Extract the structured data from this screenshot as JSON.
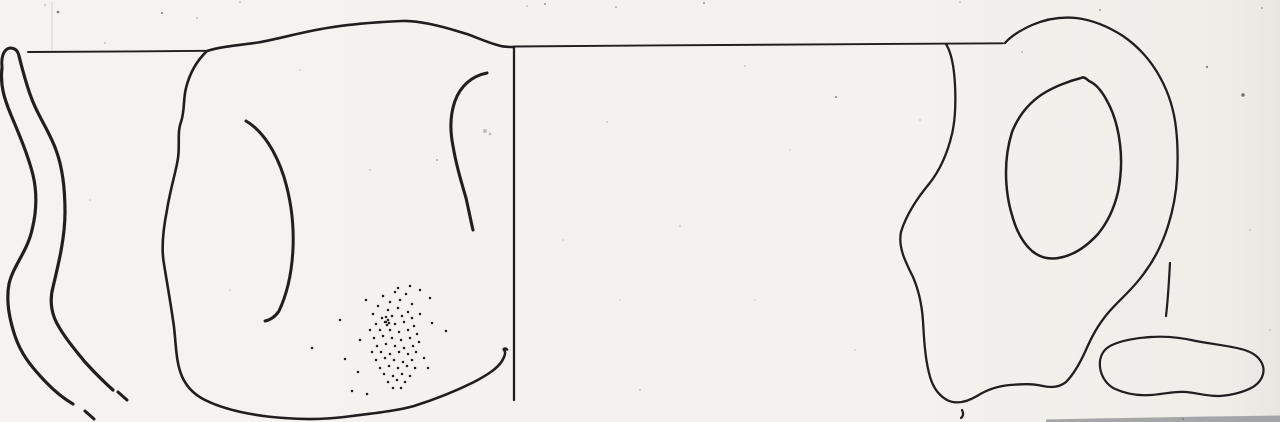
{
  "canvas": {
    "width": 1280,
    "height": 422,
    "paper_color": "#f4f2ee",
    "ink_color": "#1f1f1f",
    "shadow_color": "#97999c"
  },
  "illustration": {
    "strokes": [
      {
        "name": "paper-fold-line",
        "d": "M 52,2 L 52,50",
        "stroke": "#d9d6d0",
        "width": 1.4,
        "opacity": 0.7
      },
      {
        "name": "left-rim-level-line",
        "d": "M 28,52 C 75,51.4 150,51.6 206,50.8",
        "width": 1.9
      },
      {
        "name": "sherd-section-cap",
        "d": "M 2,67 C 1,56 4,49 10,48 C 15,48 18,51 19,56",
        "width": 3
      },
      {
        "name": "sherd-section-outer-edge",
        "d": "M 2,68 C 0,85 4,98 11,115 C 19,134 28,155 33,175 C 37,192 37,210 32,230 C 27,252 13,266 9,284 C 6,300 9,318 15,336 C 21,354 31,366 42,378 C 52,389 61,397 73,404",
        "width": 3.2
      },
      {
        "name": "sherd-section-outer-dash",
        "d": "M 85,411 L 94,419",
        "width": 3
      },
      {
        "name": "sherd-section-inner-edge",
        "d": "M 19,56 C 24,76 28,90 33,102 C 40,119 50,133 56,150 C 62,166 65,188 65,212 C 65,237 59,262 53,287 C 49,302 52,316 59,327 C 67,341 77,352 85,362 C 93,371 103,381 113,390",
        "width": 3.2
      },
      {
        "name": "sherd-section-inner-dash",
        "d": "M 118,392 L 127,400",
        "width": 3
      },
      {
        "name": "cup-profile-outline",
        "d": "M 514,47 C 508,47 503,47 499,45.5 C 489,43 478,38 467,34 C 455,30.5 445,27 430,24 C 420,22 411,20.5 402,21 C 379,22 355,23.5 330,27.5 C 301,32 281,38.5 258,42.5 C 240,45 221,46.5 207,51 C 197,60.5 190,72 186,88 C 183,100 185,110 181,122 C 177,133 180,144 178,158 C 176,172 170,190 167,210 C 163,230 161,248 164,264 C 167,283 171,305 174,327 C 176,345 176,358 180,371 C 184,384 193,394 205,400 C 225,410 254,416 284,418 C 309,420 331,419 352,416 C 375,413 396,411 414,406 C 433,400 456,391 474,382 C 487,375 497,369 502,361 C 505,356 506,352 504,350 C 503,348.5 505,348 507,349.5",
        "width": 2.6
      },
      {
        "name": "cup-interior-contour-left",
        "d": "M 246,121 C 263,131 276,152 284,177 C 291,200 294,225 293,248 C 292,272 287,294 279,311 C 275,317 270,320 265,321",
        "width": 3
      },
      {
        "name": "cup-interior-contour-right",
        "d": "M 487,73 C 471,76 460,87 455,101 C 450,115 450,131 453,146 C 456,164 461,181 466,198 C 469,211 471,222 473,230",
        "width": 3.1
      },
      {
        "name": "cup-axis-line",
        "d": "M 514,47 L 514,400",
        "width": 2.3
      },
      {
        "name": "right-rim-level-line",
        "d": "M 514,46.5 C 680,45 860,44.2 1003,43.3",
        "width": 1.9
      },
      {
        "name": "handle-outline-outer",
        "d": "M 946,44 C 951,52 954,65 955,85 C 956,105 955,121 952,134 C 948,151 941,169 929,184 C 918,197 906,215 901,232 C 898,247 905,261 913,277 C 919,291 922,306 923,321 C 924,339 925,357 929,373 C 932,386 938,395 947,400 C 956,404.5 966,402.5 977,396 C 988,389 998,386 1010,385 C 1022,384 1032,383.5 1043,386 C 1052,388 1060,387 1066,382 C 1073,375 1079,365 1085,352 C 1092,336 1098,325 1108,313 C 1118,301 1131,291 1142,276 C 1153,262 1162,245 1168,226 C 1173,210 1176,196 1177,178 C 1178,160 1178,145 1176,128 C 1174,110 1169,94 1161,79 C 1152,62 1139,47 1123,36 C 1109,27 1093,20 1076,18 C 1061,16.5 1046,19 1032,25 C 1021,30 1011,36 1005,43",
        "width": 2.3
      },
      {
        "name": "handle-opening-inner-edge",
        "d": "M 1081,78 C 1069,81 1053,87 1041,95 C 1028,104 1018,117 1012,132 C 1008,145 1006,158 1006,172 C 1006,188 1008,202 1012,215 C 1016,230 1023,243 1032,251 C 1041,258.5 1052,260 1063,257 C 1075,254 1087,246 1098,234 C 1107,223 1114,209 1118,192 C 1121,177 1122,160 1120,144 C 1118,127 1113,111 1106,99 C 1101,90 1096,84 1089,81 C 1087,79.5 1084,76 1081,78",
        "width": 2.5
      },
      {
        "name": "handle-section-position-tick",
        "d": "M 1170,263 C 1169,280 1168,300 1166,316",
        "width": 2.2
      },
      {
        "name": "handle-section-outline",
        "d": "M 1100,367 C 1099,357 1103,349 1112,345 C 1123,340 1136,338 1151,337 C 1166,336 1181,337.5 1196,341 C 1211,344 1229,345.5 1243,349.5 C 1253,352.5 1260,357 1263,366 C 1265,374 1261,382 1253,387 C 1244,392 1232,395 1220,396 C 1208,396.5 1197,393 1186,392 C 1175,391 1164,394 1151,395 C 1138,396 1125,393.5 1114,388.5 C 1106,384 1101,376 1100,367",
        "width": 2.2
      },
      {
        "name": "handle-base-tick",
        "d": "M 962,410 C 963.5,413 963.5,416 961,418",
        "width": 2.2
      },
      {
        "name": "scan-shadow-band",
        "d": "M 1046,419.5 C 1120,418 1200,416.5 1280,415.5 L 1280,422 L 1046,422 Z",
        "fill": "#97999c",
        "stroke": "none",
        "width": 0,
        "opacity": 0.85
      }
    ],
    "stipple": {
      "name": "cup-stipple-shading",
      "radius": 1.25,
      "color": "#1d1d1d",
      "dots": [
        [
          383,
          296
        ],
        [
          395,
          292
        ],
        [
          406,
          294
        ],
        [
          390,
          302
        ],
        [
          400,
          300
        ],
        [
          378,
          306
        ],
        [
          412,
          304
        ],
        [
          388,
          310
        ],
        [
          398,
          308
        ],
        [
          408,
          312
        ],
        [
          373,
          314
        ],
        [
          382,
          318
        ],
        [
          392,
          316
        ],
        [
          402,
          316
        ],
        [
          412,
          318
        ],
        [
          420,
          314
        ],
        [
          376,
          324
        ],
        [
          386,
          322
        ],
        [
          395,
          324
        ],
        [
          404,
          322
        ],
        [
          414,
          326
        ],
        [
          370,
          330
        ],
        [
          380,
          330
        ],
        [
          390,
          330
        ],
        [
          399,
          332
        ],
        [
          408,
          330
        ],
        [
          417,
          334
        ],
        [
          374,
          338
        ],
        [
          383,
          336
        ],
        [
          392,
          338
        ],
        [
          401,
          340
        ],
        [
          410,
          338
        ],
        [
          419,
          342
        ],
        [
          377,
          346
        ],
        [
          386,
          344
        ],
        [
          395,
          346
        ],
        [
          404,
          348
        ],
        [
          413,
          346
        ],
        [
          372,
          352
        ],
        [
          381,
          352
        ],
        [
          390,
          354
        ],
        [
          399,
          352
        ],
        [
          408,
          354
        ],
        [
          416,
          352
        ],
        [
          376,
          360
        ],
        [
          385,
          358
        ],
        [
          394,
          360
        ],
        [
          403,
          362
        ],
        [
          412,
          360
        ],
        [
          380,
          368
        ],
        [
          389,
          366
        ],
        [
          398,
          368
        ],
        [
          407,
          366
        ],
        [
          415,
          368
        ],
        [
          384,
          374
        ],
        [
          393,
          376
        ],
        [
          402,
          374
        ],
        [
          410,
          376
        ],
        [
          388,
          382
        ],
        [
          397,
          380
        ],
        [
          405,
          382
        ],
        [
          393,
          388
        ],
        [
          401,
          388
        ],
        [
          386,
          317
        ],
        [
          388,
          320
        ],
        [
          385,
          322
        ],
        [
          389,
          323
        ],
        [
          387,
          325
        ],
        [
          340,
          320
        ],
        [
          312,
          348
        ],
        [
          345,
          359
        ],
        [
          352,
          391
        ],
        [
          367,
          394
        ],
        [
          366,
          300
        ],
        [
          432,
          323
        ],
        [
          446,
          331
        ],
        [
          420,
          290
        ],
        [
          360,
          340
        ],
        [
          358,
          372
        ],
        [
          424,
          358
        ],
        [
          428,
          368
        ],
        [
          430,
          298
        ],
        [
          398,
          288
        ],
        [
          410,
          286
        ]
      ]
    },
    "specks": {
      "name": "scan-noise-specks",
      "color": "#3a3a3a",
      "points": [
        [
          58,
          12,
          1.3,
          0.65
        ],
        [
          162,
          13,
          1.1,
          0.55
        ],
        [
          545,
          4,
          1.0,
          0.5
        ],
        [
          616,
          7,
          0.9,
          0.45
        ],
        [
          704,
          3,
          1.0,
          0.5
        ],
        [
          836,
          97,
          1.1,
          0.5
        ],
        [
          1207,
          67,
          1.2,
          0.55
        ],
        [
          1243,
          95,
          1.7,
          0.7
        ],
        [
          1022,
          52,
          0.9,
          0.4
        ],
        [
          1100,
          10,
          1.0,
          0.45
        ],
        [
          485,
          131,
          2.0,
          0.3
        ],
        [
          490,
          134,
          1.4,
          0.3
        ],
        [
          437,
          160,
          1.0,
          0.4
        ],
        [
          370,
          170,
          0.9,
          0.3
        ],
        [
          105,
          43,
          0.9,
          0.35
        ],
        [
          197,
          18,
          0.9,
          0.35
        ],
        [
          607,
          122,
          0.9,
          0.25
        ],
        [
          745,
          66,
          0.9,
          0.25
        ],
        [
          680,
          226,
          0.9,
          0.25
        ],
        [
          527,
          6,
          0.9,
          0.35
        ],
        [
          1262,
          8,
          1.0,
          0.4
        ],
        [
          920,
          120,
          0.9,
          0.25
        ],
        [
          563,
          240,
          0.8,
          0.25
        ],
        [
          755,
          300,
          0.8,
          0.25
        ],
        [
          855,
          350,
          0.8,
          0.25
        ],
        [
          640,
          390,
          0.9,
          0.3
        ],
        [
          230,
          290,
          0.8,
          0.25
        ],
        [
          90,
          200,
          0.8,
          0.25
        ],
        [
          300,
          70,
          0.8,
          0.25
        ],
        [
          1183,
          419,
          1.0,
          0.4
        ],
        [
          45,
          5,
          0.9,
          0.35
        ],
        [
          240,
          2,
          0.9,
          0.35
        ],
        [
          960,
          2,
          0.9,
          0.3
        ],
        [
          1120,
          160,
          0.8,
          0.25
        ],
        [
          1250,
          230,
          0.8,
          0.3
        ],
        [
          1270,
          330,
          0.8,
          0.3
        ],
        [
          620,
          300,
          0.8,
          0.2
        ],
        [
          790,
          150,
          0.8,
          0.2
        ]
      ]
    }
  }
}
